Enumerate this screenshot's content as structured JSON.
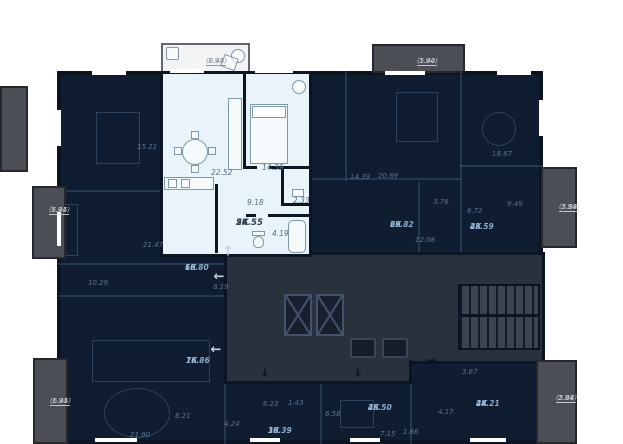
{
  "colors": {
    "page_bg": "#ffffff",
    "dark_unit_bg": "#101d30",
    "highlight_bg": "#e9f3fa",
    "corridor_bg": "#29313d",
    "balcony_gray": "#4b4e55",
    "balcony_white": "#f1f3f4",
    "wall": "#0a1423",
    "highlight_line": "#7d97ad"
  },
  "selected_apartment": {
    "type_label": "2К",
    "total_area": "54.55",
    "room_areas": [
      "22.52",
      "14.39",
      "9.18",
      "2.33",
      "4.19"
    ],
    "balcony_area": "1.94",
    "balcony_area_total": "(6.45)"
  },
  "labels": [
    {
      "text": "22.52",
      "x": 211,
      "y": 169,
      "kind": "hl-room"
    },
    {
      "text": "14.39",
      "x": 262,
      "y": 164,
      "kind": "hl-room"
    },
    {
      "text": "9.18",
      "x": 247,
      "y": 199,
      "kind": "hl-room"
    },
    {
      "text": "2.33",
      "x": 293,
      "y": 197,
      "kind": "hl-room"
    },
    {
      "text": "4.19",
      "x": 272,
      "y": 230,
      "kind": "hl-room"
    },
    {
      "text": "2К",
      "text2": "54.55",
      "x": 236,
      "y": 219,
      "kind": "hl-unit"
    },
    {
      "text": "1.94",
      "text2": "(6.45)",
      "x": 206,
      "y": 57,
      "kind": "bal-light-lbl"
    },
    {
      "text": "1.94",
      "text2": "(5.40)",
      "x": 417,
      "y": 57,
      "kind": "bal-gray-lbl"
    },
    {
      "text": "1.94",
      "text2": "(6.45)",
      "x": 49,
      "y": 206,
      "kind": "bal-gray-lbl"
    },
    {
      "text": "1.94",
      "text2": "(6.45)",
      "x": 50,
      "y": 397,
      "kind": "bal-gray-lbl"
    },
    {
      "text": "2.94",
      "text2": "(5.88)",
      "x": 559,
      "y": 203,
      "kind": "bal-gray-lbl"
    },
    {
      "text": "2.94",
      "text2": "(5.88)",
      "x": 556,
      "y": 394,
      "kind": "bal-gray-lbl"
    },
    {
      "text": "15.21",
      "x": 137,
      "y": 143,
      "kind": "dim"
    },
    {
      "text": "21.47",
      "x": 143,
      "y": 241,
      "kind": "dim"
    },
    {
      "text": "10.29",
      "x": 88,
      "y": 279,
      "kind": "dim"
    },
    {
      "text": "1К",
      "text2": "60.80",
      "x": 185,
      "y": 264,
      "kind": "unit-dim"
    },
    {
      "text": "8.19",
      "x": 213,
      "y": 283,
      "kind": "dim"
    },
    {
      "text": "1К",
      "text2": "76.86",
      "x": 186,
      "y": 357,
      "kind": "unit-dim"
    },
    {
      "text": "6.21",
      "x": 175,
      "y": 412,
      "kind": "dim"
    },
    {
      "text": "21.90",
      "x": 130,
      "y": 431,
      "kind": "dim"
    },
    {
      "text": "4.24",
      "x": 224,
      "y": 420,
      "kind": "dim"
    },
    {
      "text": "6.22",
      "x": 263,
      "y": 400,
      "kind": "dim"
    },
    {
      "text": "1.43",
      "x": 288,
      "y": 399,
      "kind": "dim"
    },
    {
      "text": "1К",
      "text2": "30.39",
      "x": 268,
      "y": 427,
      "kind": "unit-dim"
    },
    {
      "text": "6.58",
      "x": 325,
      "y": 410,
      "kind": "dim"
    },
    {
      "text": "2К",
      "text2": "45.50",
      "x": 368,
      "y": 404,
      "kind": "unit-dim"
    },
    {
      "text": "7.15",
      "x": 380,
      "y": 430,
      "kind": "dim"
    },
    {
      "text": "1.66",
      "x": 403,
      "y": 428,
      "kind": "dim"
    },
    {
      "text": "4.17",
      "x": 438,
      "y": 408,
      "kind": "dim"
    },
    {
      "text": "2К",
      "text2": "44.21",
      "x": 476,
      "y": 400,
      "kind": "unit-dim"
    },
    {
      "text": "3.67",
      "x": 462,
      "y": 368,
      "kind": "dim"
    },
    {
      "text": "14.39",
      "x": 350,
      "y": 173,
      "kind": "dim"
    },
    {
      "text": "20.89",
      "x": 378,
      "y": 172,
      "kind": "dim"
    },
    {
      "text": "3.78",
      "x": 433,
      "y": 198,
      "kind": "dim"
    },
    {
      "text": "2К",
      "text2": "69.82",
      "x": 390,
      "y": 221,
      "kind": "unit-dim"
    },
    {
      "text": "12.08",
      "x": 415,
      "y": 236,
      "kind": "dim"
    },
    {
      "text": "18.67",
      "x": 492,
      "y": 150,
      "kind": "dim"
    },
    {
      "text": "9.49",
      "x": 507,
      "y": 200,
      "kind": "dim"
    },
    {
      "text": "6.72",
      "x": 467,
      "y": 207,
      "kind": "dim"
    },
    {
      "text": "2К",
      "text2": "43.59",
      "x": 470,
      "y": 223,
      "kind": "unit-dim"
    }
  ],
  "arrows": [
    {
      "dir": "up",
      "x": 228,
      "y": 252,
      "tone": "light"
    },
    {
      "dir": "left",
      "x": 219,
      "y": 277,
      "tone": "light"
    },
    {
      "dir": "left",
      "x": 216,
      "y": 350,
      "tone": "light"
    },
    {
      "dir": "down",
      "x": 265,
      "y": 373,
      "tone": "dark"
    },
    {
      "dir": "down",
      "x": 358,
      "y": 373,
      "tone": "dark"
    },
    {
      "dir": "right",
      "x": 431,
      "y": 361,
      "tone": "dark"
    }
  ],
  "units": [
    {
      "id": "unit-2k-54-55",
      "label": "2К 54.55",
      "x": 160,
      "y": 71,
      "w": 152,
      "h": 186,
      "selected": true
    },
    {
      "id": "unit-1k-60-80",
      "label": "1К 60.80",
      "x": 57,
      "y": 71,
      "w": 103,
      "h": 193,
      "selected": false
    },
    {
      "id": "unit-2k-69-82",
      "label": "2К 69.82",
      "x": 312,
      "y": 71,
      "w": 148,
      "h": 182,
      "selected": false
    },
    {
      "id": "unit-2k-43-59",
      "label": "2К 43.59",
      "x": 460,
      "y": 71,
      "w": 83,
      "h": 182,
      "selected": false
    },
    {
      "id": "unit-1k-76-86",
      "label": "1К 76.86",
      "x": 57,
      "y": 290,
      "w": 167,
      "h": 154,
      "selected": false
    },
    {
      "id": "unit-1k-30-39",
      "label": "1К 30.39",
      "x": 224,
      "y": 384,
      "w": 96,
      "h": 60,
      "selected": false
    },
    {
      "id": "unit-2k-45-50",
      "label": "2К 45.50",
      "x": 320,
      "y": 384,
      "w": 90,
      "h": 60,
      "selected": false
    },
    {
      "id": "unit-2k-44-21",
      "label": "2К 44.21",
      "x": 412,
      "y": 364,
      "w": 131,
      "h": 80,
      "selected": false
    }
  ]
}
